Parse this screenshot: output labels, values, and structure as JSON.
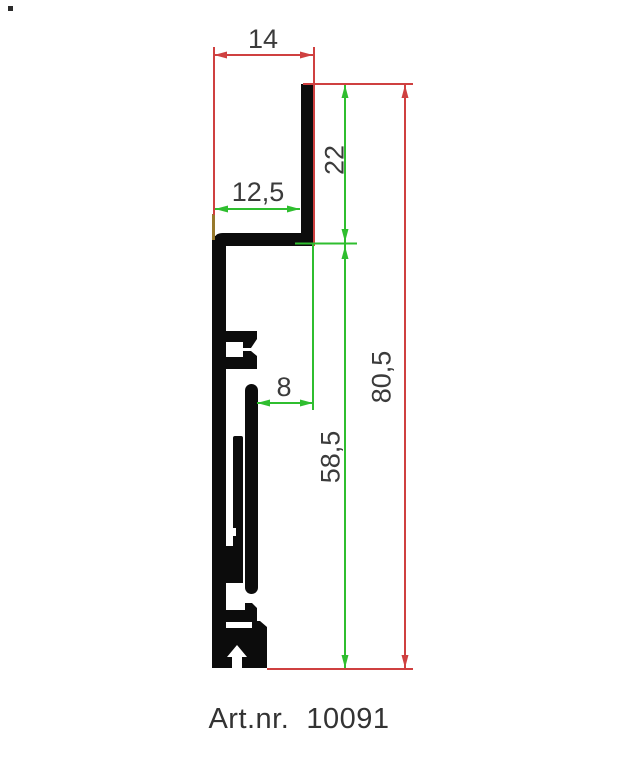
{
  "drawing": {
    "caption": "Art.nr.  10091",
    "dimensions": {
      "overall_width": "14",
      "ledge_width": "12,5",
      "top_channel_height": "22",
      "rib_offset": "8",
      "body_height": "58,5",
      "overall_height": "80,5"
    },
    "colors": {
      "red_dimension": "#cf4040",
      "green_dimension": "#2fbe2f",
      "dimension_text": "#3b3b3b",
      "profile_fill": "#0c0c0c",
      "olive_tick": "#97792c",
      "background": "#ffffff"
    }
  }
}
